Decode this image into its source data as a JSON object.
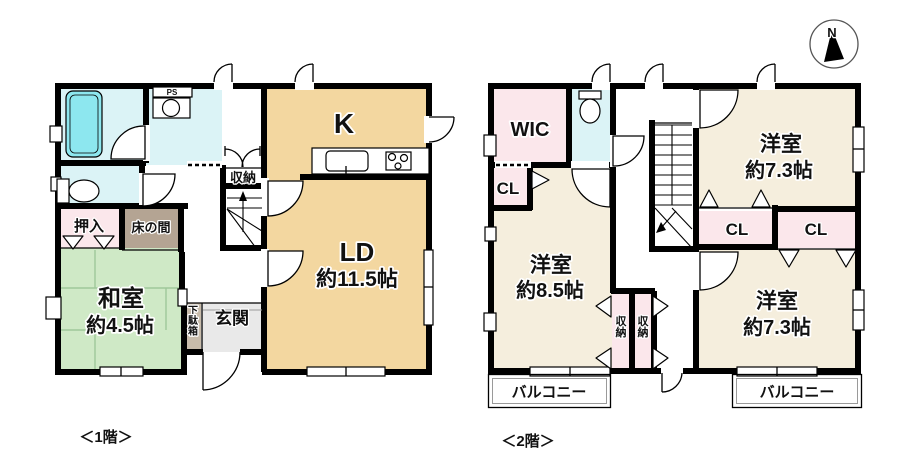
{
  "palette": {
    "ldk_tan": "#f3d7a0",
    "bedroom_cream": "#f5eedd",
    "tatami_green": "#cfe9c6",
    "wet_area_aqua": "#dbf3f6",
    "bathtub_cyan": "#8de7ef",
    "closet_pink": "#fbe7eb",
    "tokonoma_taupe": "#b4a493",
    "getabako_taupe": "#c8bcab",
    "genkan_gray": "#e9e9e9",
    "wall_black": "#000000"
  },
  "compass": {
    "label": "N"
  },
  "captions": {
    "floor1": "＜1階＞",
    "floor2": "＜2階＞"
  },
  "floor1": {
    "rooms": {
      "kitchen": {
        "label": "K"
      },
      "living_dining": {
        "label": "LD",
        "size": "約11.5帖"
      },
      "washitsu": {
        "label": "和室",
        "size": "約4.5帖"
      },
      "oshiire": {
        "label": "押入"
      },
      "tokonoma": {
        "label": "床の間"
      },
      "storage": {
        "label": "収納"
      },
      "genkan": {
        "label": "玄関"
      },
      "getabako": {
        "label": "下駄箱"
      },
      "ps": {
        "label": "PS"
      }
    }
  },
  "floor2": {
    "rooms": {
      "wic": {
        "label": "WIC"
      },
      "cl_west": {
        "label": "CL"
      },
      "cl_center": {
        "label": "CL"
      },
      "cl_east": {
        "label": "CL"
      },
      "bedroom_85": {
        "label": "洋室",
        "size": "約8.5帖"
      },
      "bedroom_73_north": {
        "label": "洋室",
        "size": "約7.3帖"
      },
      "bedroom_73_south": {
        "label": "洋室",
        "size": "約7.3帖"
      },
      "storage_west": {
        "label": "収納"
      },
      "storage_east": {
        "label": "収納"
      },
      "balcony_west": {
        "label": "バルコニー"
      },
      "balcony_east": {
        "label": "バルコニー"
      }
    }
  }
}
